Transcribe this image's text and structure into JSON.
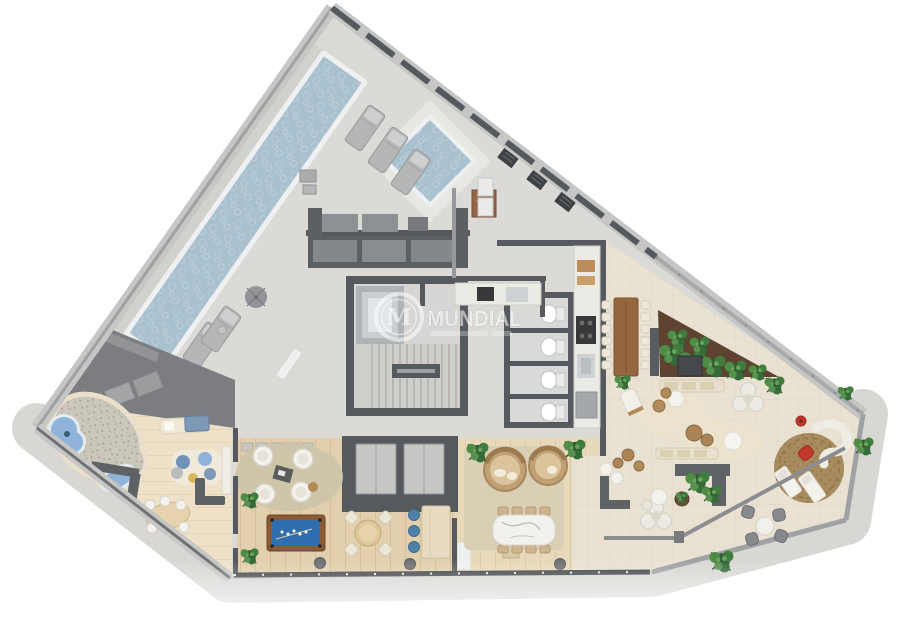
{
  "watermark": {
    "brand": "MUNDIAL",
    "logo_letter": "M"
  },
  "palette": {
    "deck_concrete": "#dcdad6",
    "terrace_tile": "#e9e2d3",
    "wood_deck": "#e2cfad",
    "nook_wood": "#e9d9bb",
    "kids_floor": "#eee1c8",
    "pool_water": "#a9c0ce",
    "kids_water": "#8fb3d9",
    "wall_dark": "#55585c",
    "roof_gray": "#7b7d80",
    "walkway": "#d8d7d4",
    "plant_green": "#3c7040",
    "accent_red": "#c2392b",
    "billiard_felt": "#2f6fae",
    "marble": "#f2f1ed",
    "watermark_white": "#ffffff"
  }
}
